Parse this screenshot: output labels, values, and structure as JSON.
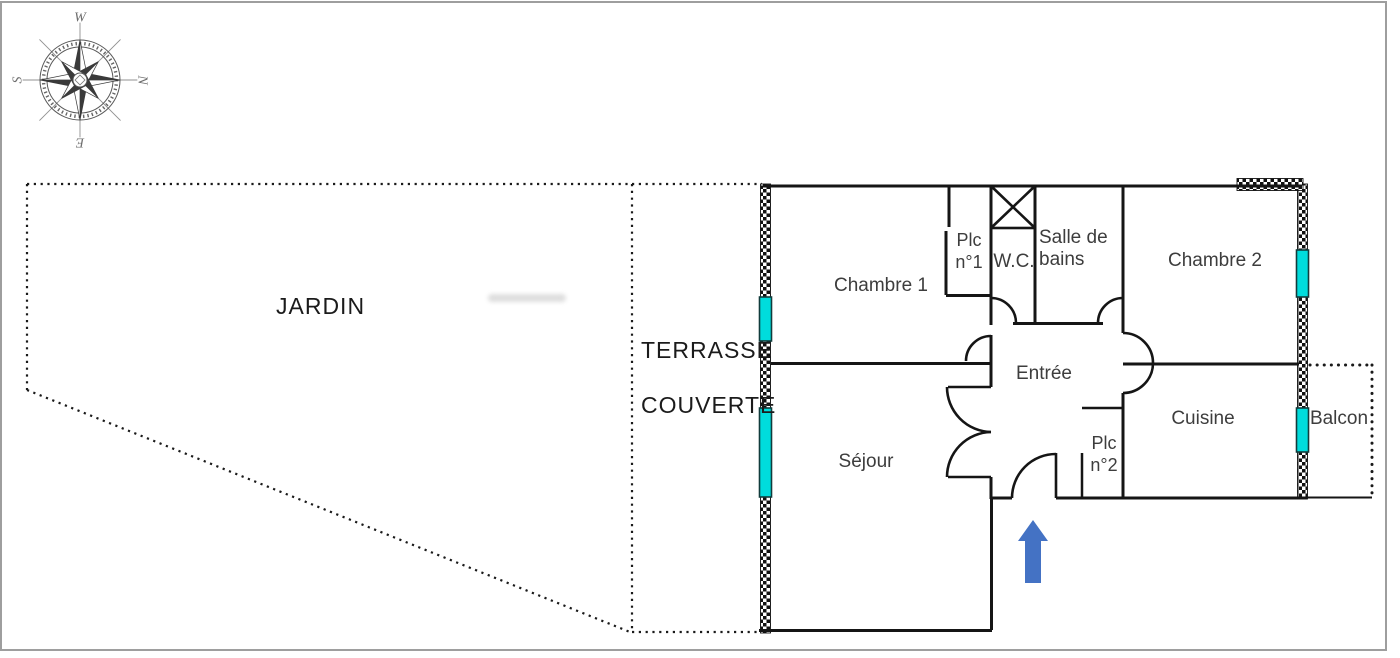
{
  "areas": {
    "jardin": "JARDIN",
    "terrasse_line1": "TERRASSE",
    "terrasse_line2": "COUVERTE"
  },
  "rooms": {
    "chambre1": "Chambre 1",
    "plc1_line1": "Plc",
    "plc1_line2": "n°1",
    "wc": "W.C.",
    "sdb_line1": "Salle de",
    "sdb_line2": "bains",
    "chambre2": "Chambre 2",
    "entree": "Entrée",
    "cuisine": "Cuisine",
    "sejour": "Séjour",
    "plc2_line1": "Plc",
    "plc2_line2": "n°2",
    "balcon": "Balcon"
  },
  "compass": {
    "top": "W",
    "right": "N",
    "bottom": "E",
    "left": "S"
  },
  "colors": {
    "window": "#00dcdc",
    "arrow": "#4472c4",
    "wall": "#151515",
    "frame": "#9e9e9e"
  }
}
